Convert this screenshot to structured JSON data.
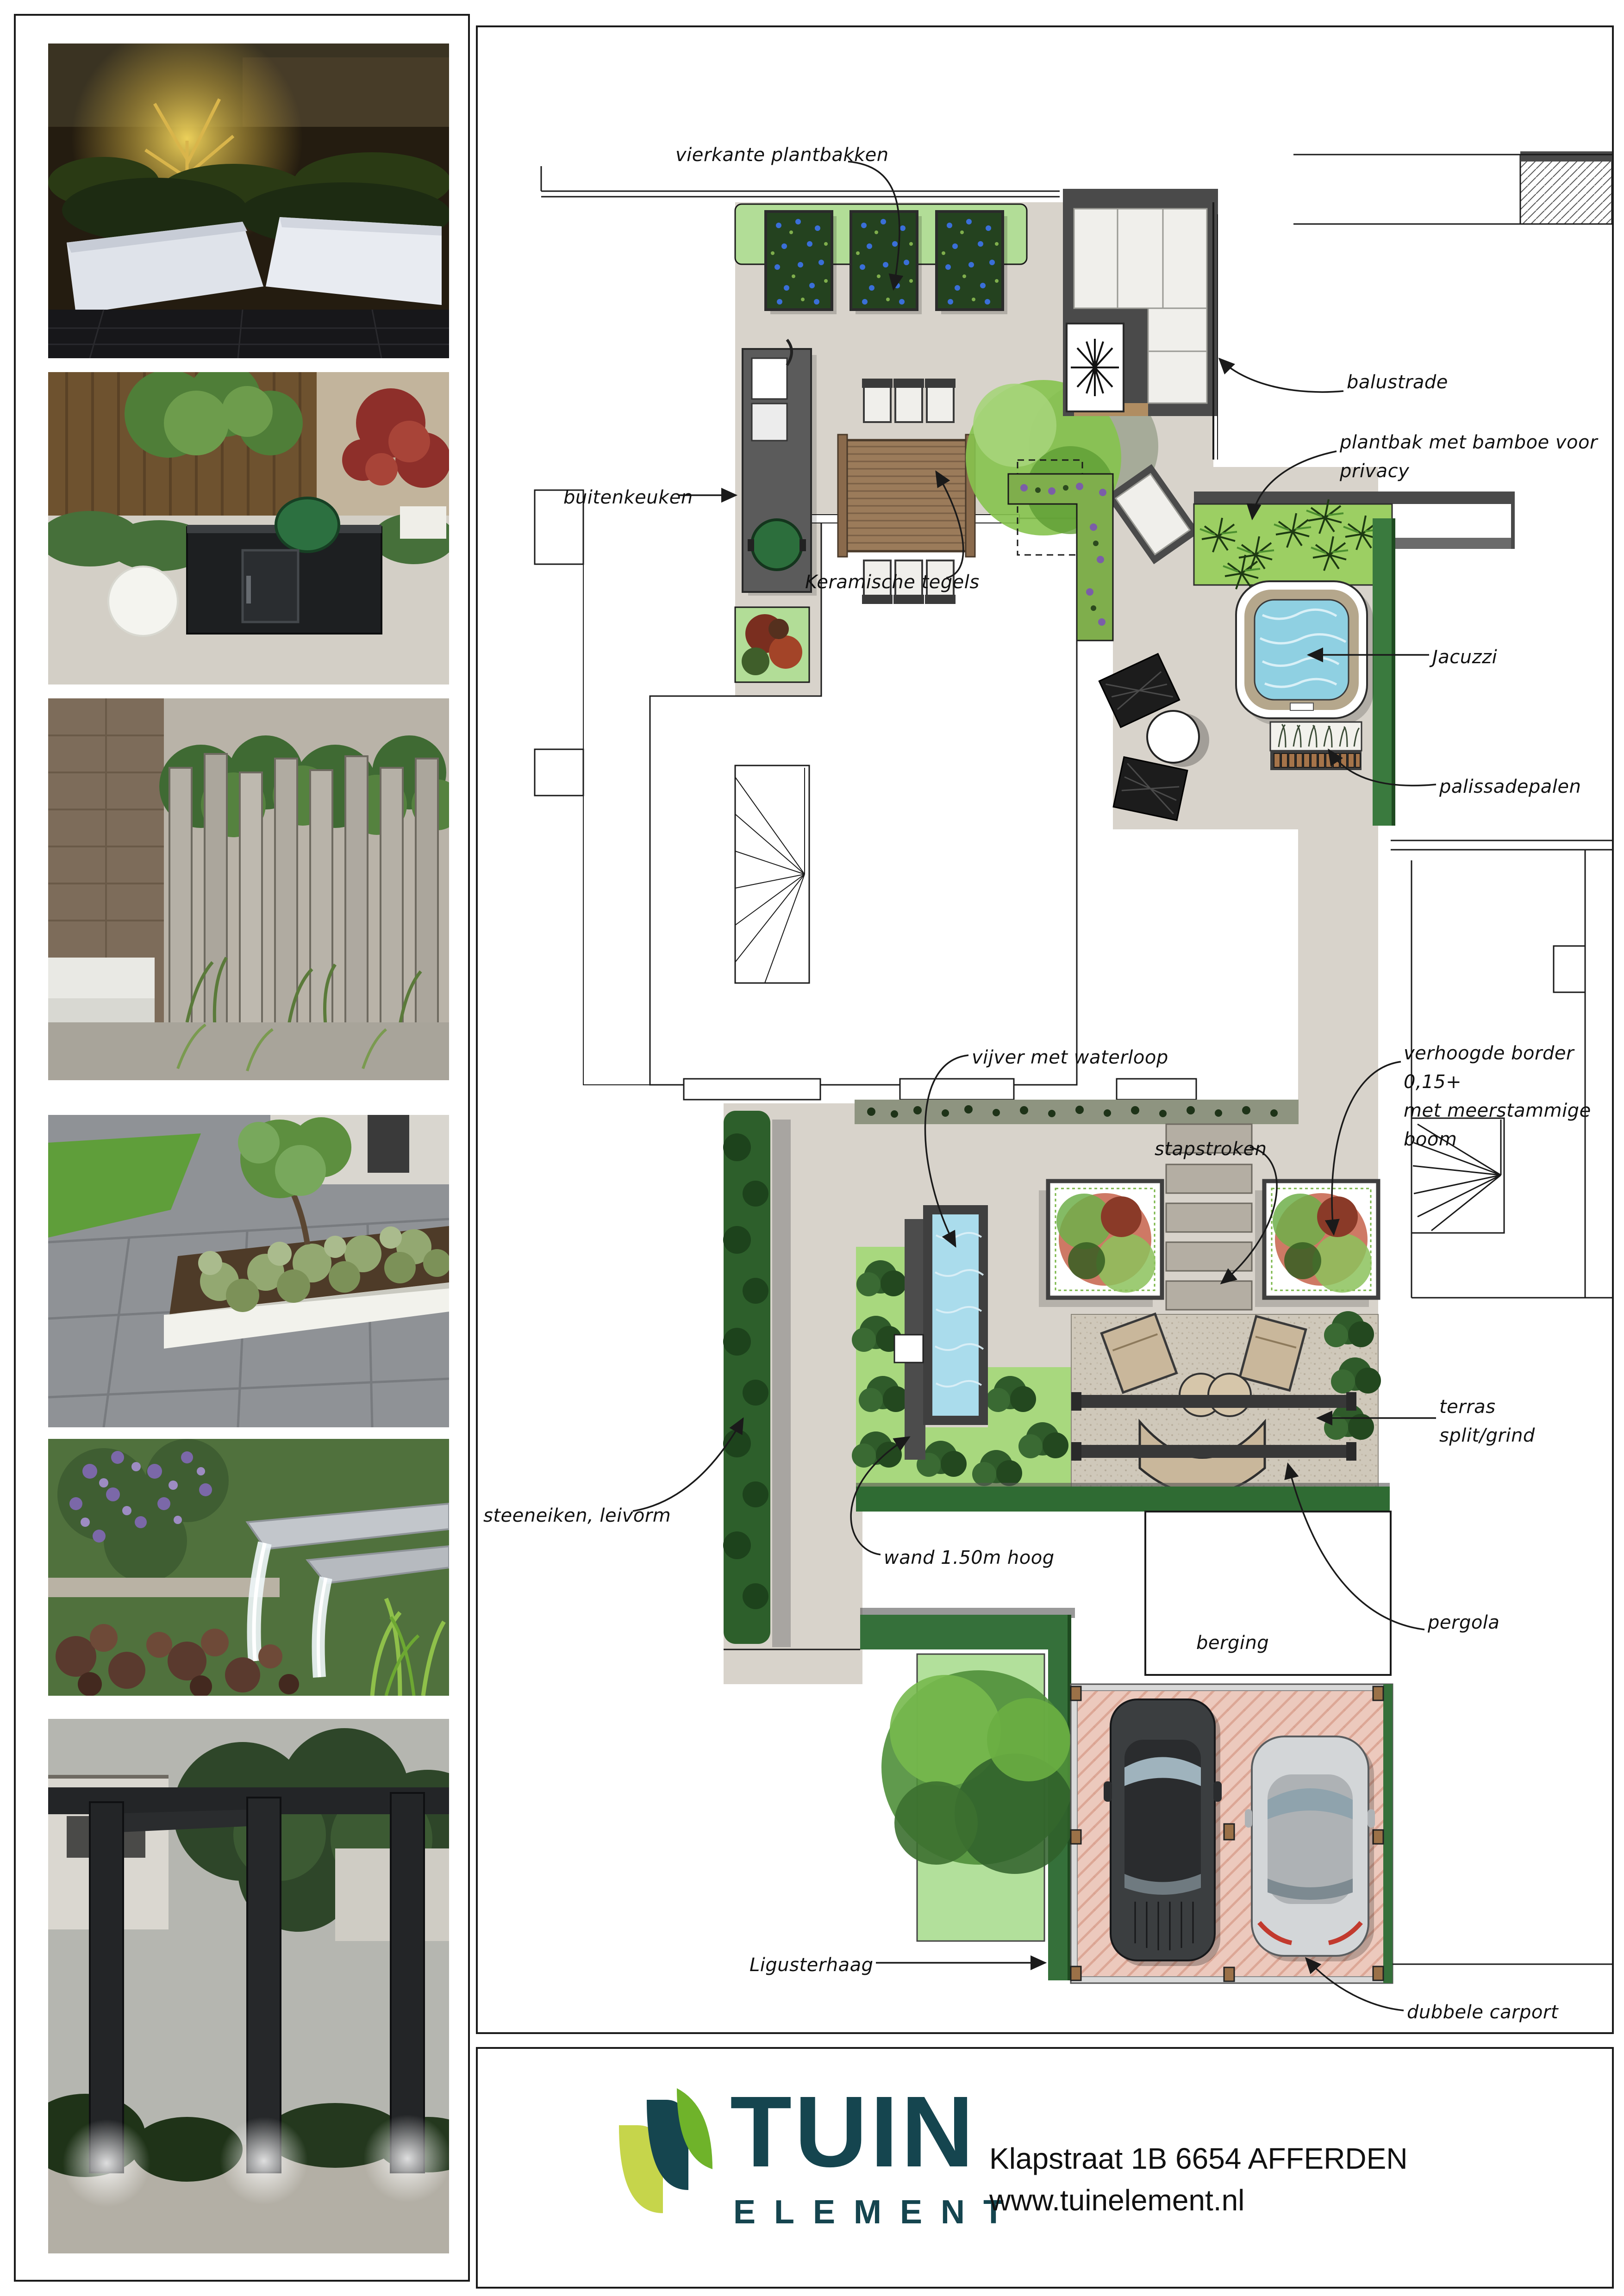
{
  "plan": {
    "labels": {
      "vierkante": "vierkante plantbakken",
      "buitenkeuken": "buitenkeuken",
      "balustrade": "balustrade",
      "plantbak_bamboe": "plantbak met bamboe voor privacy",
      "jacuzzi": "Jacuzzi",
      "palissadepalen": "palissadepalen",
      "keramische": "Keramische tegels",
      "vijver": "vijver met waterloop",
      "stapstroken": "stapstroken",
      "verhoogde": "verhoogde border 0,15+\nmet meerstammige boom",
      "steeneiken": "steeneiken, leivorm",
      "terras": "terras\nsplit/grind",
      "wand": "wand 1.50m hoog",
      "pergola": "pergola",
      "berging": "berging",
      "ligusterhaag": "Ligusterhaag",
      "carport": "dubbele carport"
    }
  },
  "sidebar": {
    "photos": [
      {
        "name": "uplit-tree-white-planters-night"
      },
      {
        "name": "outdoor-kitchen-green-egg"
      },
      {
        "name": "vertical-timber-palisade-fence"
      },
      {
        "name": "white-border-planter-lavender"
      },
      {
        "name": "steel-waterfall-spouts"
      },
      {
        "name": "dark-pergola-posts-night"
      }
    ]
  },
  "footer": {
    "brand_top": "TUIN",
    "brand_bottom": "ELEMENT",
    "address": "Klapstraat 1B  6654 AFFERDEN",
    "website": "www.tuinelement.nl"
  },
  "colors": {
    "brand_teal": "#15454f",
    "brand_green": "#6fb32a",
    "brand_yellow_green": "#c6d54b",
    "tile_grey": "#d8d3cb",
    "gravel": "#cfc8ba",
    "water": "#8fd0e2",
    "planting_light": "#b2dd97",
    "planting_dark": "#2f6b33",
    "carport_paving": "#ecc9bd"
  }
}
